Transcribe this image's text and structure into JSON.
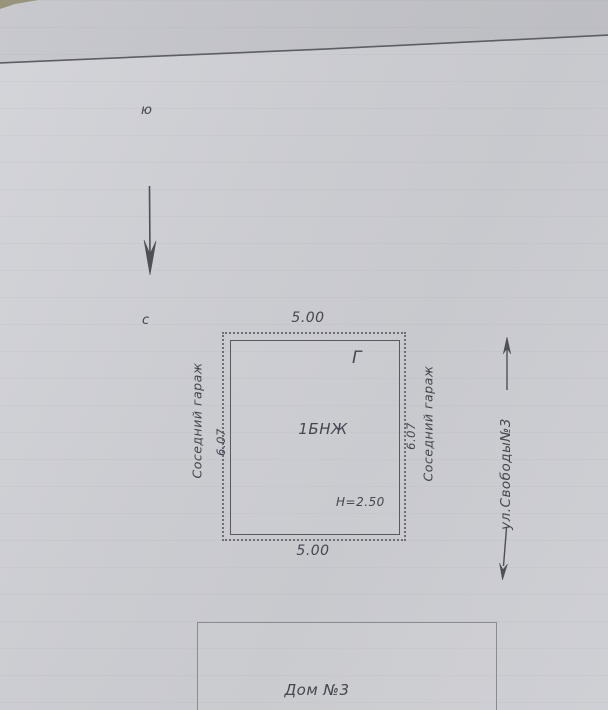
{
  "plan": {
    "compass": {
      "south": "ю",
      "north": "с"
    },
    "garage": {
      "label": "1БНЖ",
      "corner_mark": "Г",
      "height_note": "Н=2.50",
      "dim_top": "5.00",
      "dim_bottom": "5.00",
      "dim_left": "6.07",
      "dim_right": "6.07",
      "neighbor_left": "Соседний гараж",
      "neighbor_right": "Соседний гараж"
    },
    "street_label": "ул.Свободы№3",
    "house_label": "Дом №3"
  },
  "colors": {
    "ink": "#4a4a53",
    "paper": "#cfd0d5",
    "outline": "#585862"
  }
}
